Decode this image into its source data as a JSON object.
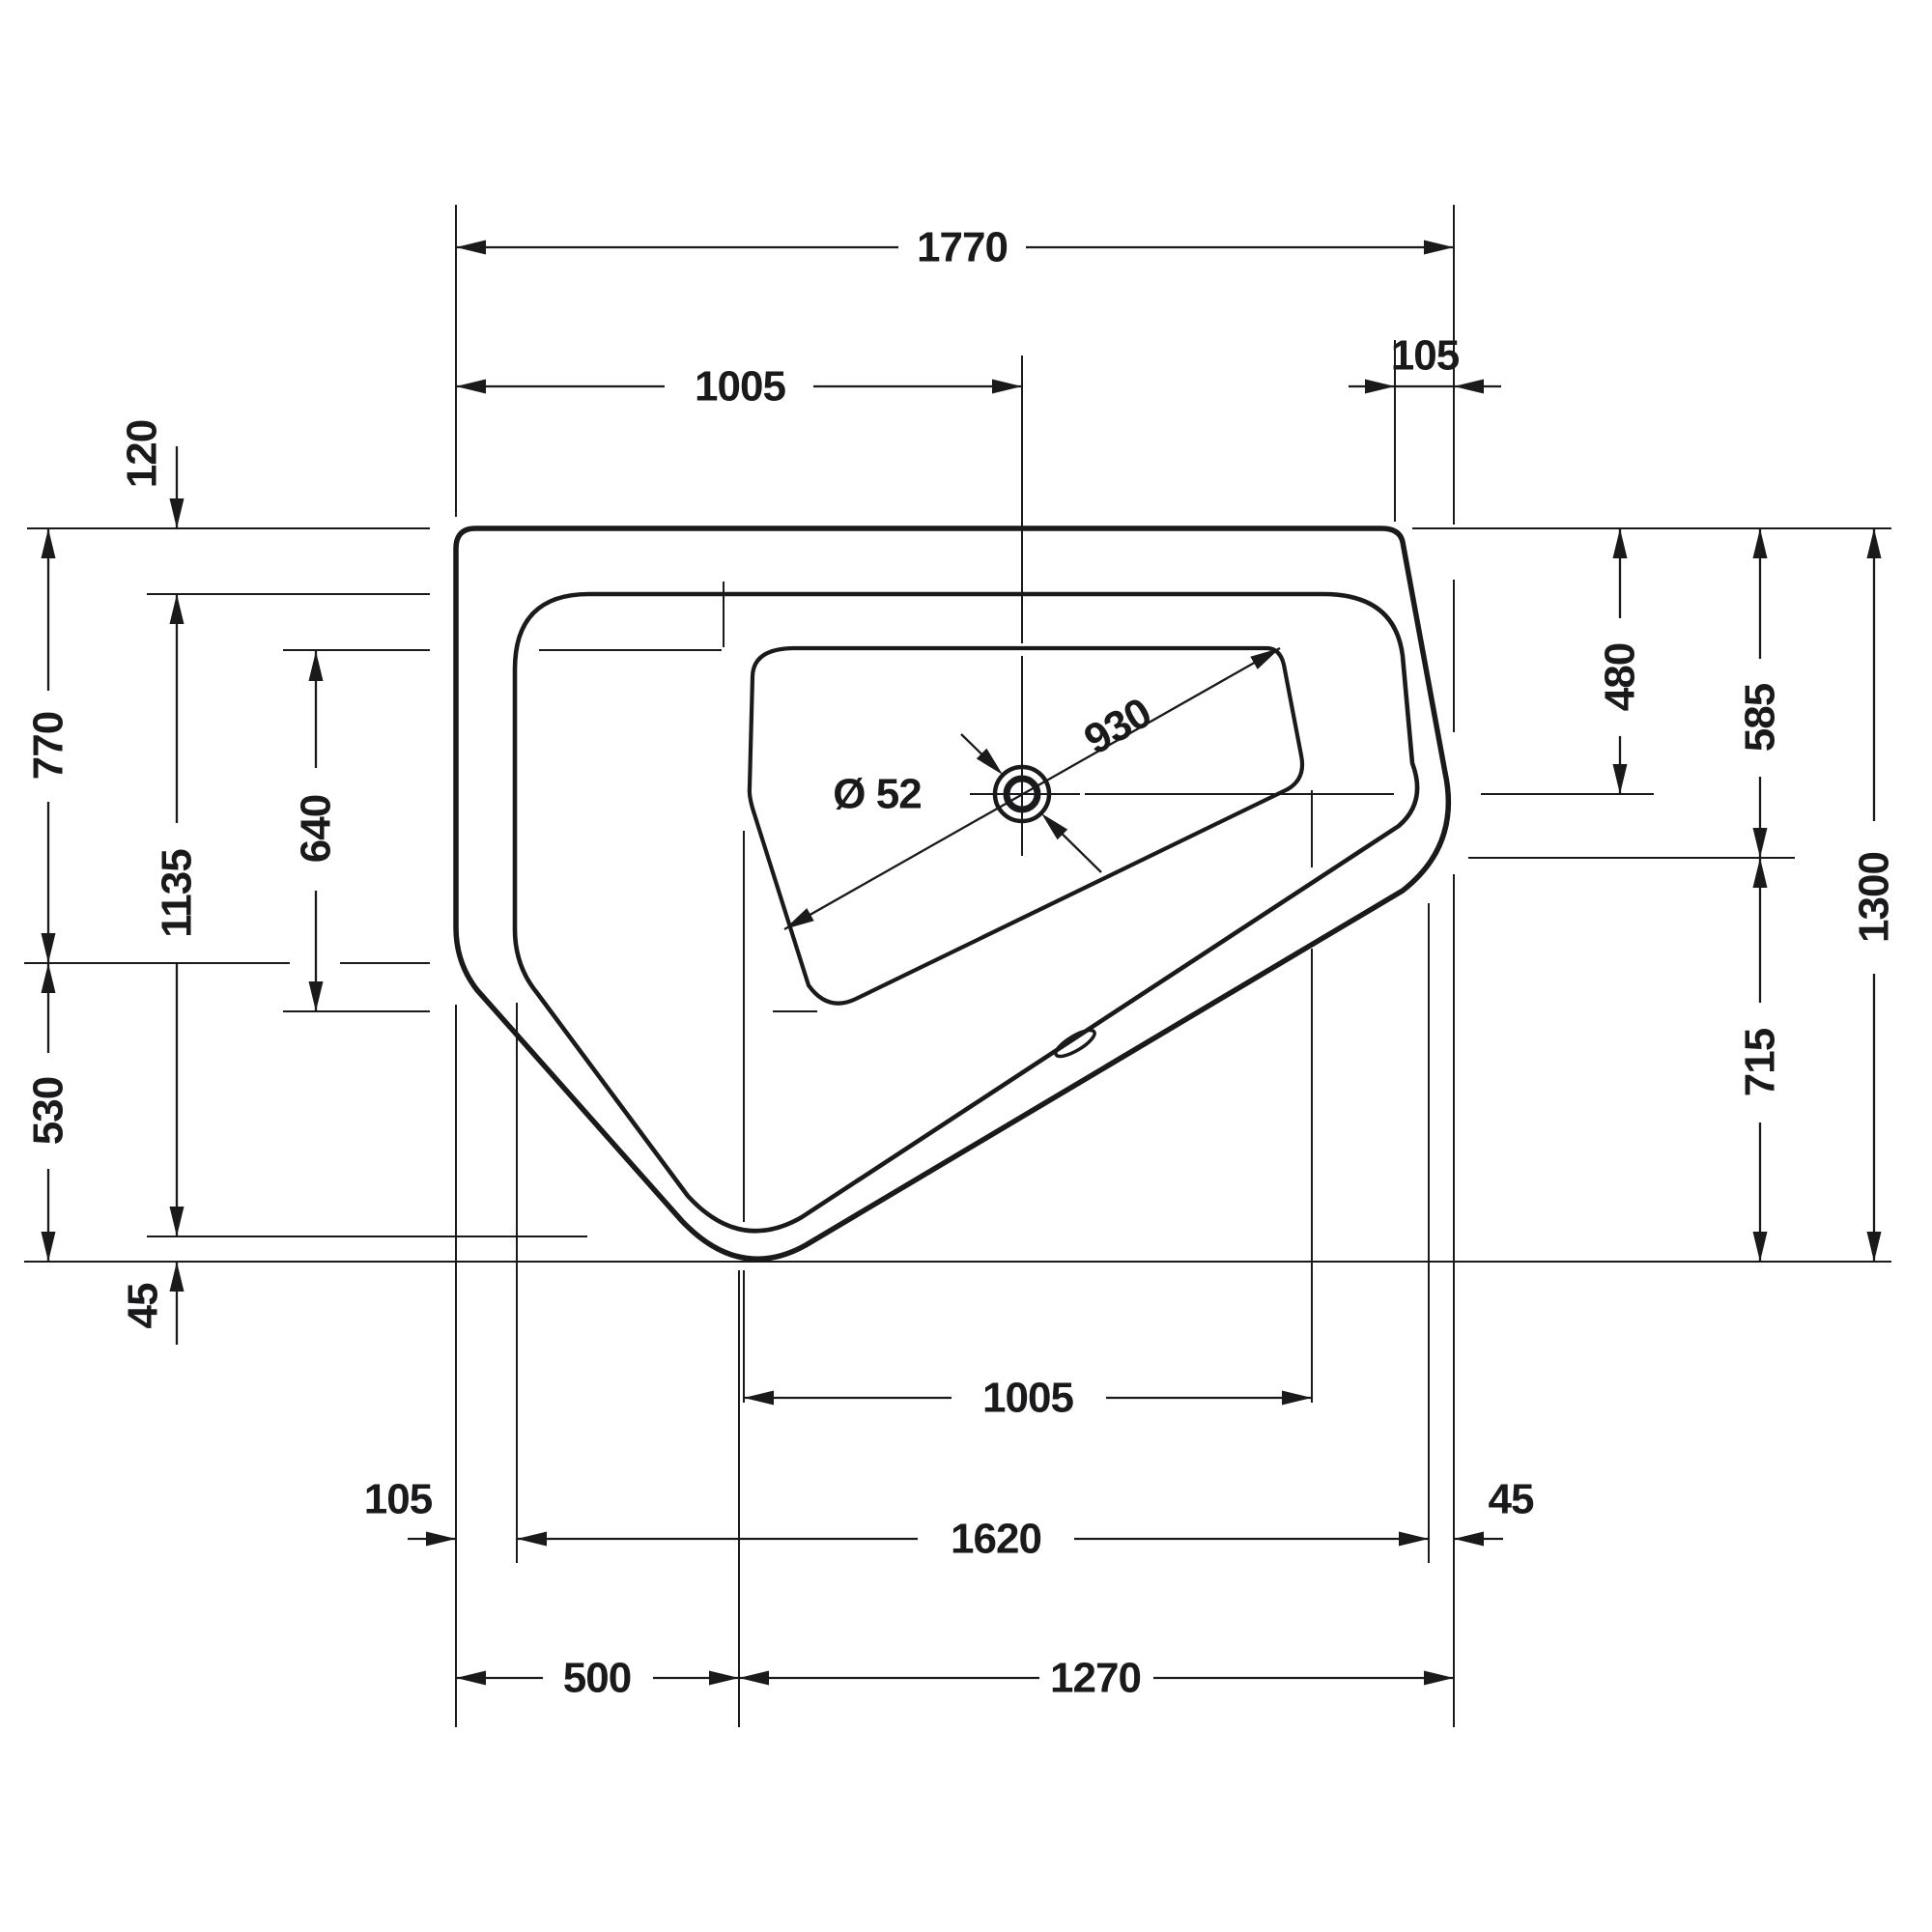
{
  "title": "Corner bathtub technical plan drawing",
  "colors": {
    "ink": "#1a1a1c",
    "background": "#ffffff"
  },
  "dimensions": {
    "top_overall_width": "1770",
    "top_drain_offset": "1005",
    "top_right_corner_offset": "105",
    "rim_top_inset": "120",
    "left_to_side_bend": "770",
    "rim_left_height": "1135",
    "basin_left_height": "640",
    "left_bend_to_bottom": "530",
    "rim_bottom_gap": "45",
    "drain_diameter": "Ø 52",
    "basin_diagonal": "930",
    "rim_right_inset_height": "480",
    "right_to_corner": "585",
    "overall_depth": "1300",
    "corner_to_bottom": "715",
    "basin_bottom_width": "1005",
    "bottom_left_offset": "105",
    "bottom_span": "1620",
    "bottom_right_gap": "45",
    "bottom_vertex_offset": "500",
    "bottom_vertex_to_right": "1270"
  }
}
